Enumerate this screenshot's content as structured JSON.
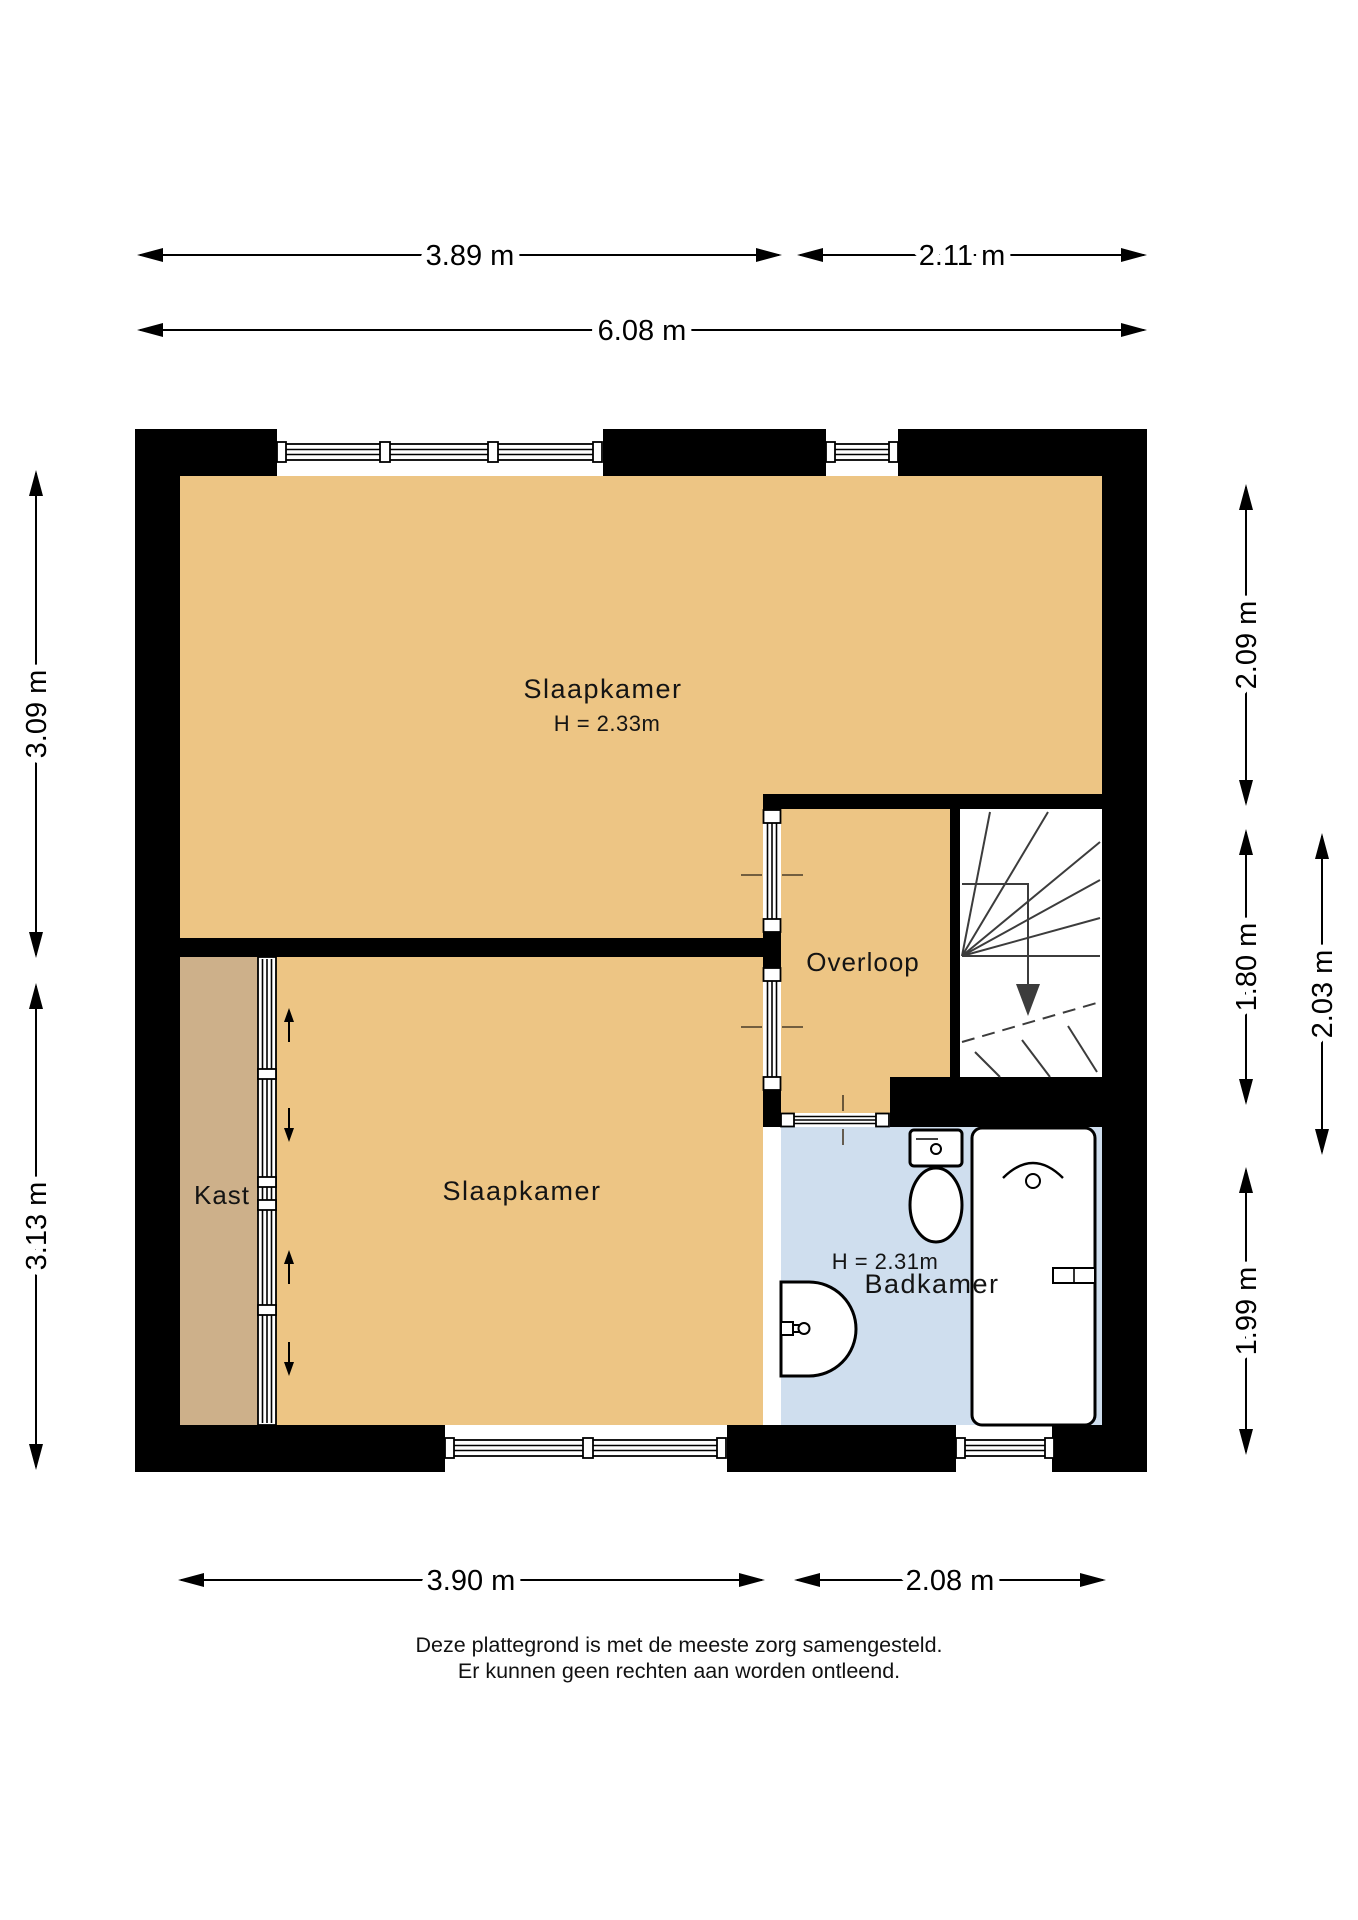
{
  "rooms": {
    "slaapkamer_top": {
      "label": "Slaapkamer",
      "ceiling_height": "H = 2.33m"
    },
    "slaapkamer_bottom": {
      "label": "Slaapkamer"
    },
    "kast": {
      "label": "Kast"
    },
    "overloop": {
      "label": "Overloop"
    },
    "badkamer": {
      "label": "Badkamer",
      "ceiling_height": "H = 2.31m"
    }
  },
  "dimensions": {
    "top_left": "3.89 m",
    "top_right": "2.11 m",
    "top_total": "6.08 m",
    "bottom_left": "3.90 m",
    "bottom_right": "2.08 m",
    "left_upper": "3.09 m",
    "left_lower": "3.13 m",
    "right_upper": "2.09 m",
    "right_middle": "1.80 m",
    "right_lower": "1.99 m",
    "right_outer": "2.03 m"
  },
  "footer": {
    "line1": "Deze plattegrond is met de meeste zorg samengesteld.",
    "line2": "Er kunnen geen rechten aan worden ontleend."
  },
  "colors": {
    "wall": "#000000",
    "bedroom_floor": "#EDC584",
    "kast_floor": "#CDB08A",
    "bathroom_floor": "#CFDEEE",
    "stair_lines": "#3C3C3C",
    "dimension_lines": "#000000",
    "background": "#FFFFFF"
  }
}
